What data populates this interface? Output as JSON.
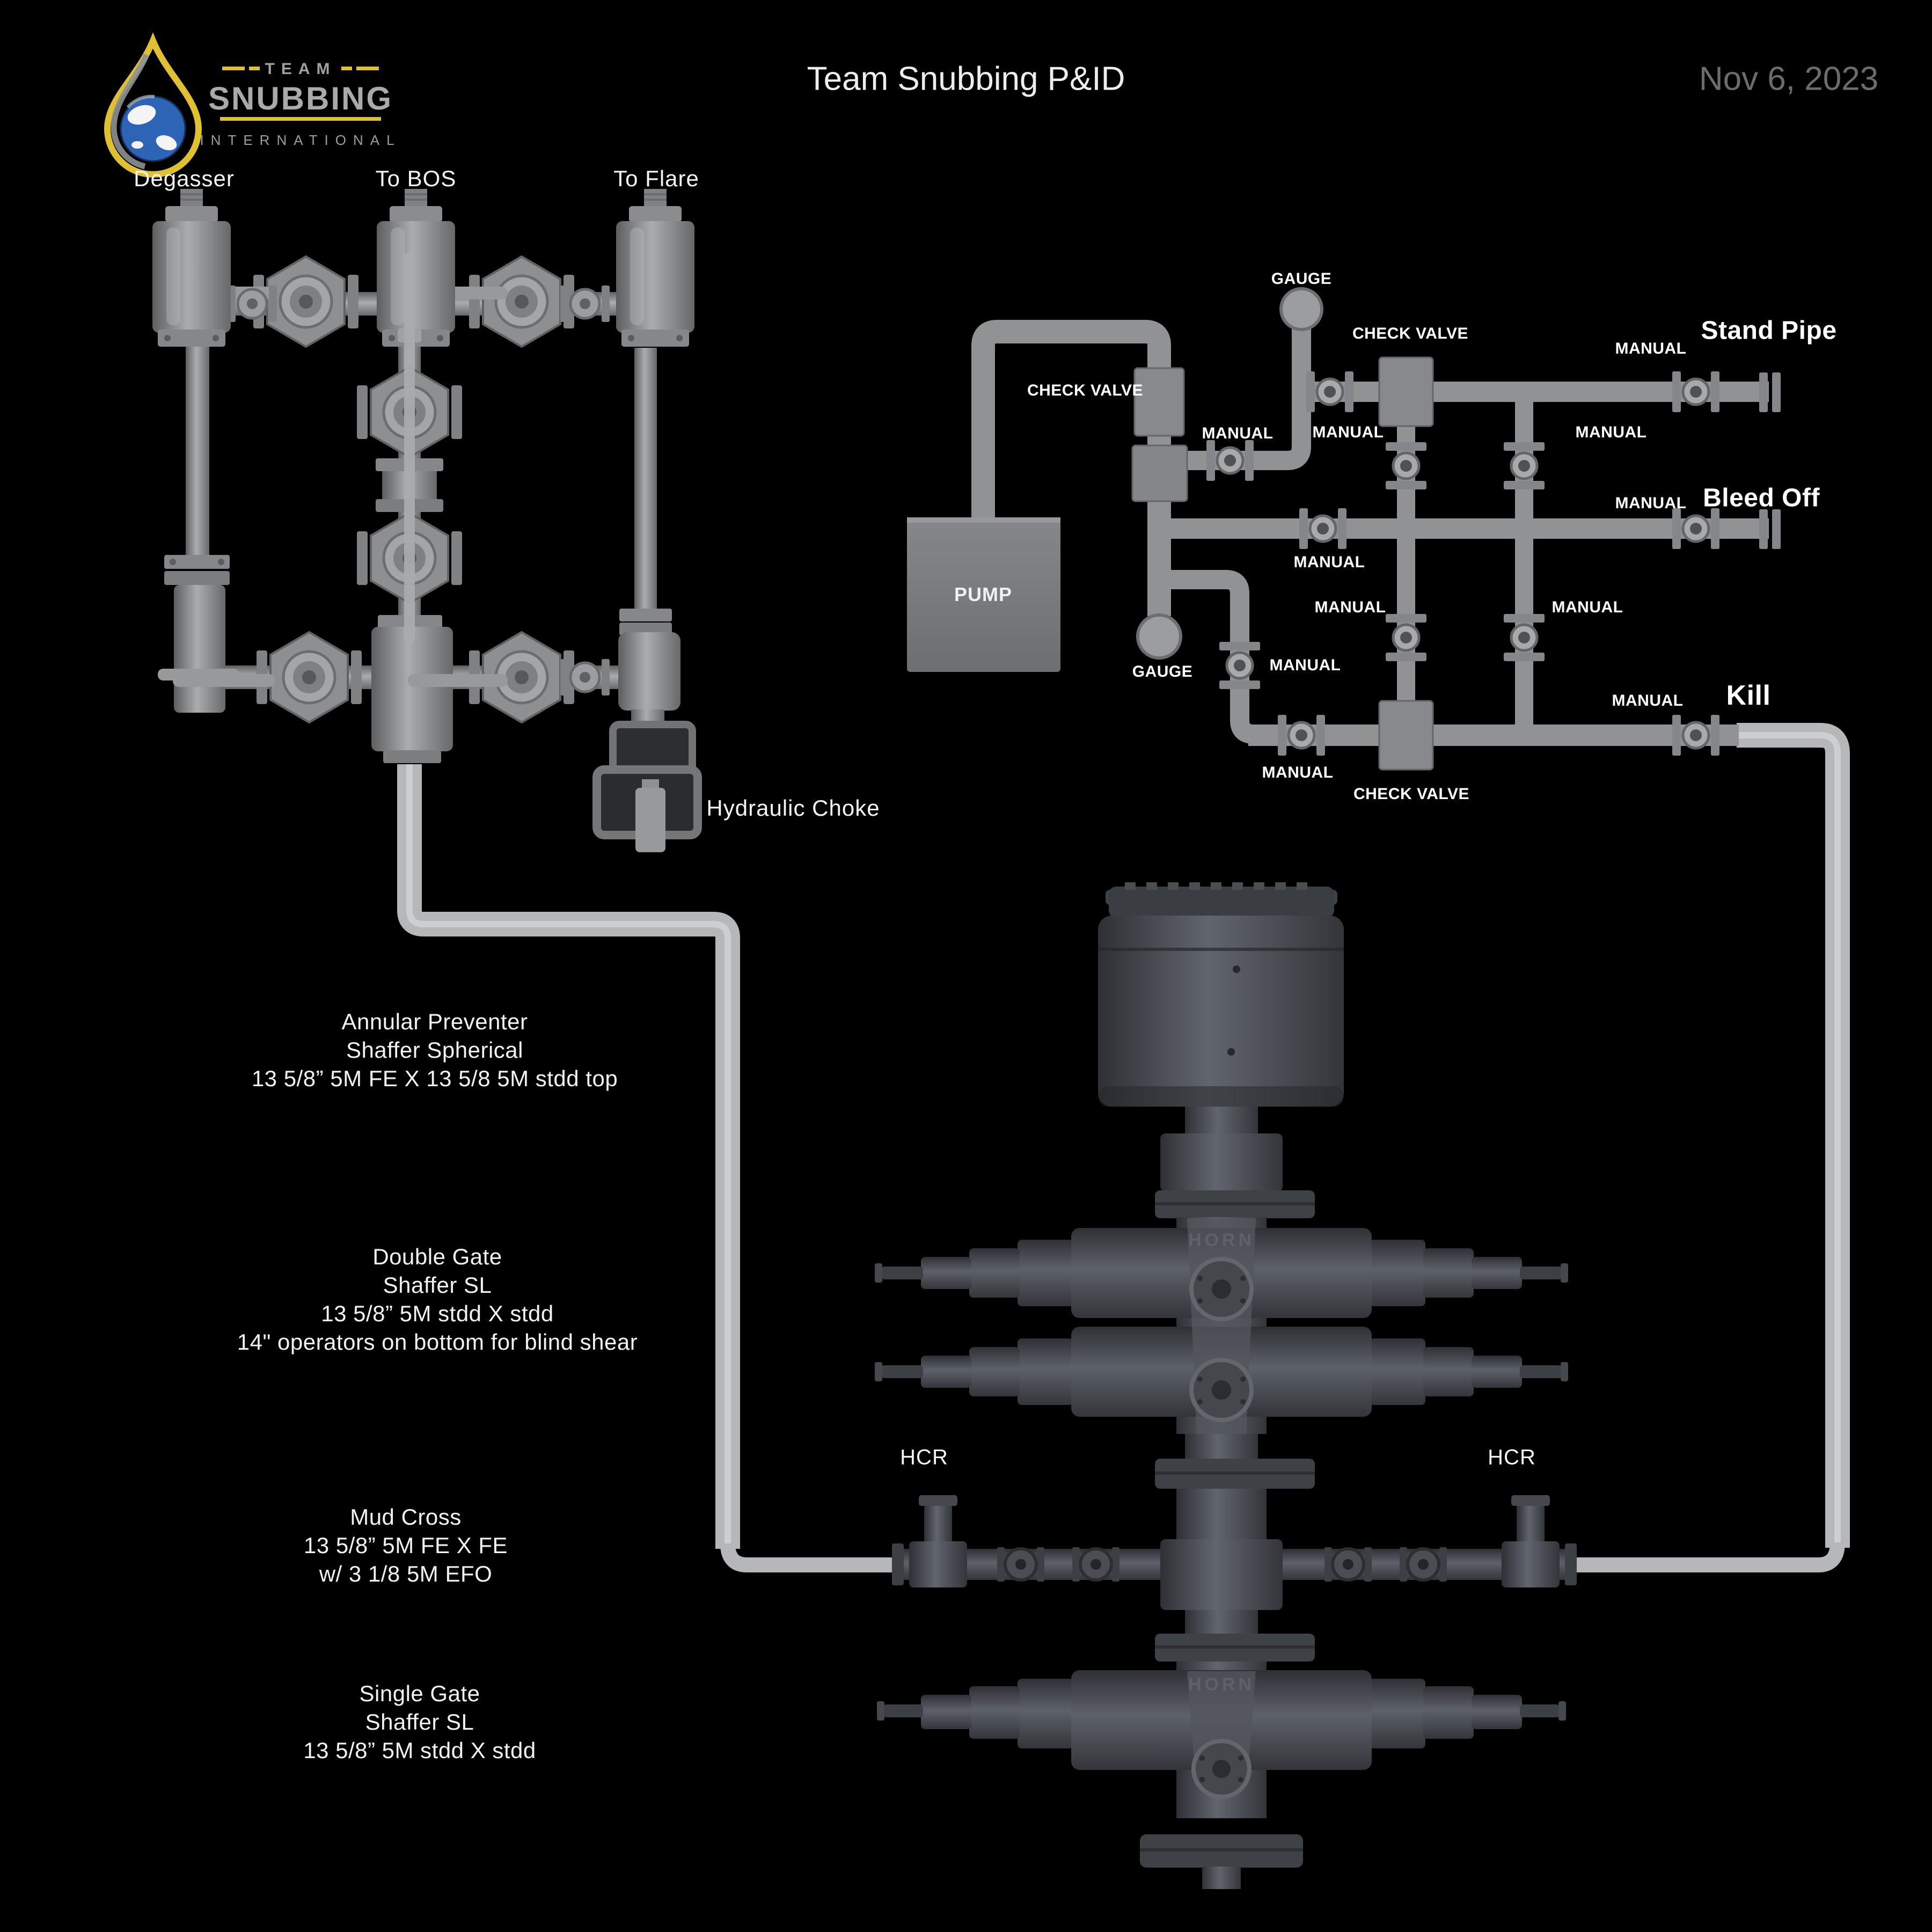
{
  "page": {
    "title": "Team Snubbing P&ID",
    "date": "Nov 6, 2023"
  },
  "logo": {
    "team": "TEAM",
    "name": "SNUBBING",
    "sub": "INTERNATIONAL"
  },
  "choke_manifold": {
    "degasser": "Degasser",
    "to_bos": "To BOS",
    "to_flare": "To Flare",
    "hydraulic_choke": "Hydraulic Choke"
  },
  "pump_manifold": {
    "pump": "PUMP",
    "gauge": "GAUGE",
    "manual": "MANUAL",
    "check_valve": "CHECK VALVE",
    "stand_pipe": "Stand Pipe",
    "bleed_off": "Bleed Off",
    "kill": "Kill"
  },
  "bop_stack": {
    "hcr": "HCR",
    "brand": "HORN",
    "annular": {
      "l1": "Annular Preventer",
      "l2": "Shaffer Spherical",
      "l3": "13 5/8” 5M FE X 13 5/8 5M stdd top"
    },
    "double_gate": {
      "l1": "Double Gate",
      "l2": "Shaffer SL",
      "l3": "13 5/8” 5M stdd X stdd",
      "l4": "14\" operators on bottom for blind shear"
    },
    "mud_cross": {
      "l1": "Mud Cross",
      "l2": "13 5/8” 5M FE X FE",
      "l3": "w/ 3 1/8 5M EFO"
    },
    "single_gate": {
      "l1": "Single Gate",
      "l2": "Shaffer SL",
      "l3": "13 5/8” 5M stdd X stdd"
    }
  },
  "colors": {
    "background": "#000000",
    "pipe_grey": "#8f9193",
    "light_pipe": "#b5b7b9",
    "bop_dark": "#44474d",
    "accent_yellow": "#dfc033",
    "globe_blue": "#2d64b5",
    "date_grey": "#6c6c6c"
  }
}
